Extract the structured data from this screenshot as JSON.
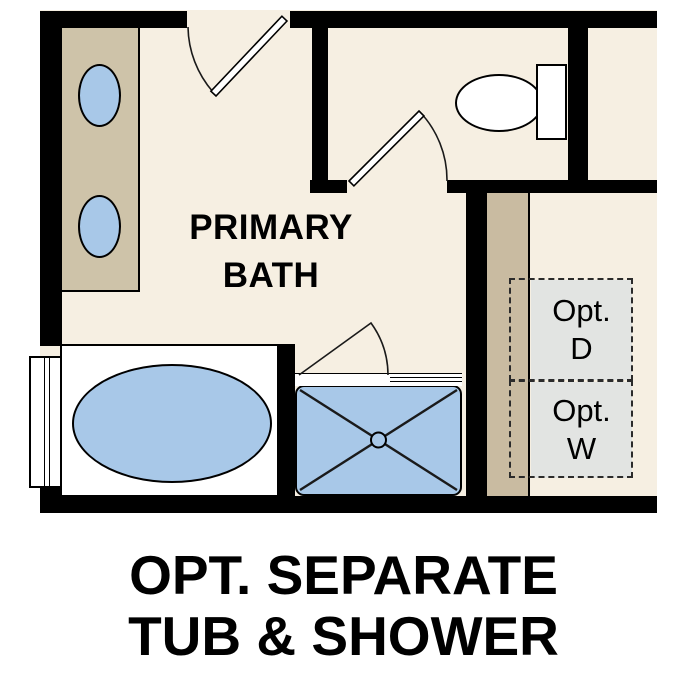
{
  "room_label": {
    "line1": "PRIMARY",
    "line2": "BATH"
  },
  "optional_appliances": {
    "dryer": {
      "line1": "Opt.",
      "line2": "D"
    },
    "washer": {
      "line1": "Opt.",
      "line2": "W"
    }
  },
  "caption": {
    "line1": "OPT. SEPARATE",
    "line2": "TUB & SHOWER"
  },
  "fixtures": [
    "double-vanity-with-two-sinks",
    "toilet",
    "oval-bathtub",
    "walk-in-shower-with-drain",
    "window",
    "bath-entry-door",
    "water-closet-door",
    "shower-door",
    "optional-dryer-location",
    "optional-washer-location"
  ],
  "colors": {
    "floor": "#f6efe2",
    "counter": "#cec3a9",
    "strip": "#c9bba1",
    "fixture": "#a8c8e8",
    "optbox": "#e2e4e2",
    "wall": "#000000"
  }
}
